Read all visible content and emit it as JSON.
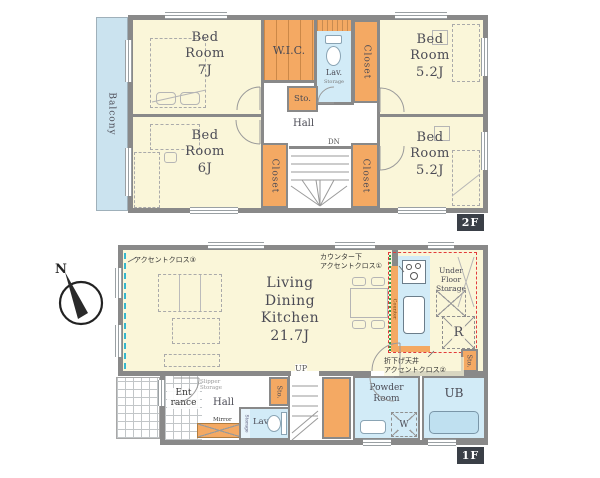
{
  "compass": {
    "north_label": "N"
  },
  "floor2": {
    "tag": "2F",
    "balcony_label": "Balcony",
    "bedroom7": "Bed\nRoom\n7J",
    "bedroom6": "Bed\nRoom\n6J",
    "bedroom52_top": "Bed\nRoom\n5.2J",
    "bedroom52_bottom": "Bed\nRoom\n5.2J",
    "wic": "W.I.C.",
    "lavatory": "Lav.",
    "lavatory_storage": "Storage",
    "closet_top_right": "Closet",
    "closet_bottom_left": "Closet",
    "closet_bottom_right": "Closet",
    "storage_small": "Sto.",
    "hall": "Hall",
    "stairs_down": "DN"
  },
  "floor1": {
    "tag": "1F",
    "ldk": "Living\nDining\nKitchen\n21.7J",
    "accent_cloth_1": "カウンター下\nアクセントクロス①",
    "accent_cloth_2": "折下げ天井\nアクセントクロス②",
    "accent_cloth_3": "アクセントクロス③",
    "under_floor_storage": "Under\nFloor\nStorage",
    "refrigerator": "R",
    "counter": "Counter",
    "kitchen_storage": "Sto.",
    "stairs_up": "UP",
    "entrance": "Ent\nrance",
    "hall": "Hall",
    "slipper_storage": "Slipper\nStorage",
    "mirror": "Mirror",
    "hall_storage": "Sto.",
    "lavatory": "Lav.",
    "lavatory_storage": "Storage",
    "powder_room": "Powder\nRoom",
    "washer": "W",
    "unit_bath": "UB"
  },
  "colors": {
    "wall": "#898989",
    "room_cream": "#faf6d9",
    "storage_orange": "#f4a963",
    "wet_area_blue": "#d2ebf7",
    "balcony_blue": "#cbe3ef",
    "floor_tag_bg": "#3a3f47",
    "accent_red_dash": "#e23b3b",
    "accent_green_dot": "#2f9e49",
    "accent_teal_dash": "#35b6ce"
  }
}
